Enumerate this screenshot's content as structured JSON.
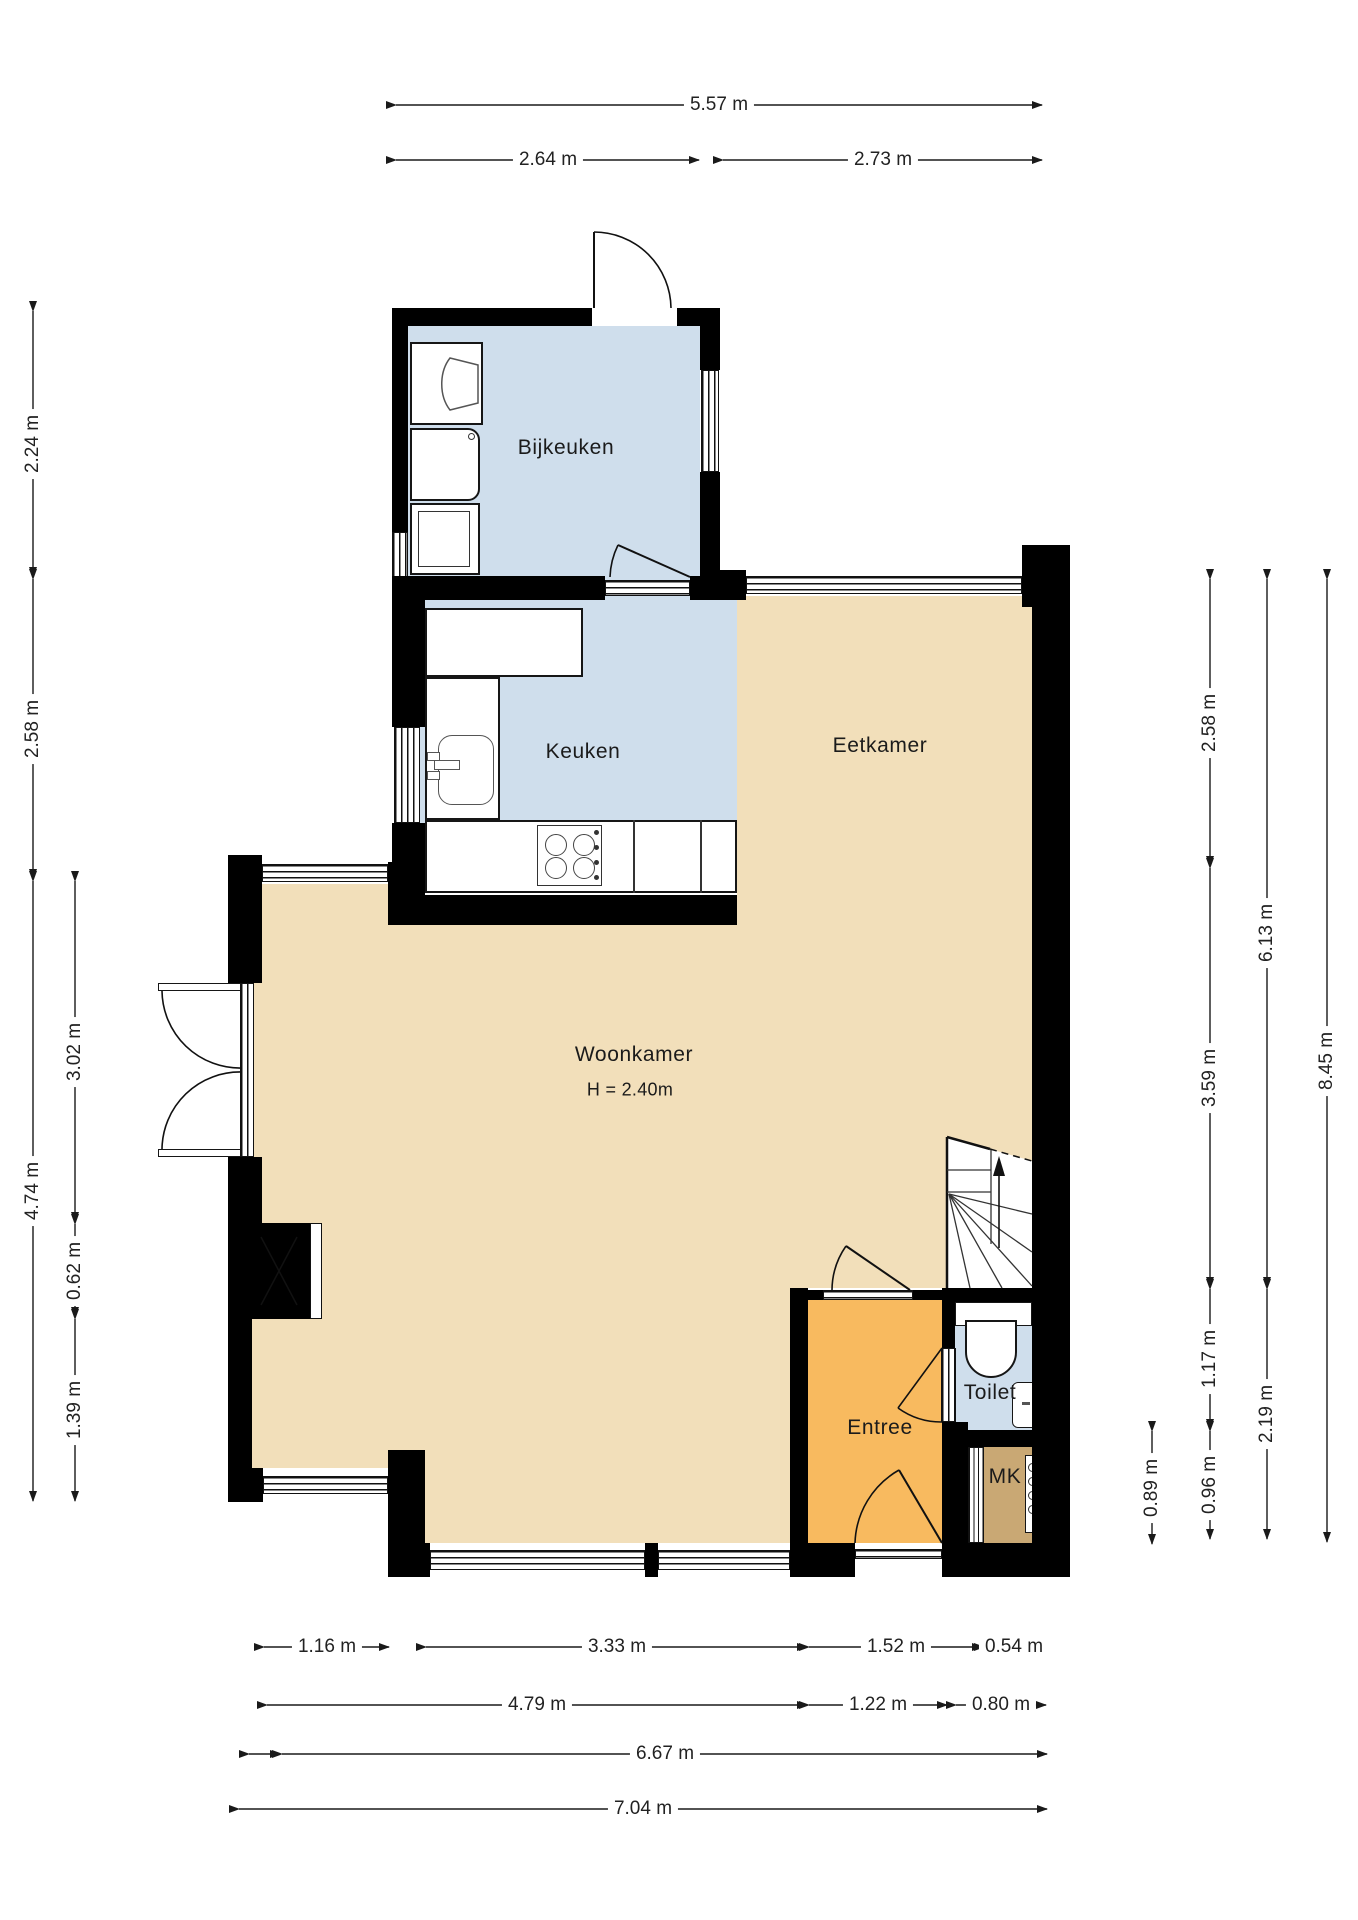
{
  "plan": {
    "type": "floorplan",
    "language": "nl"
  },
  "colors": {
    "wall": "#000000",
    "living": "#f2dfba",
    "kitchen": "#cfdeec",
    "entree": "#f8ba5f",
    "mk": "#c9a874",
    "line": "#1a1a1a"
  },
  "rooms": {
    "bijkeuken": {
      "label": "Bijkeuken"
    },
    "keuken": {
      "label": "Keuken"
    },
    "eetkamer": {
      "label": "Eetkamer"
    },
    "woonkamer": {
      "label": "Woonkamer",
      "height_note": "H = 2.40m"
    },
    "entree": {
      "label": "Entree"
    },
    "toilet": {
      "label": "Toilet"
    },
    "mk": {
      "label": "MK"
    }
  },
  "dimensions": {
    "top": [
      {
        "label": "5.57 m"
      },
      {
        "label": "2.64 m"
      },
      {
        "label": "2.73 m"
      }
    ],
    "left_outer": [
      {
        "label": "2.24 m"
      },
      {
        "label": "2.58 m"
      },
      {
        "label": "4.74 m"
      }
    ],
    "left_inner": [
      {
        "label": "3.02 m"
      },
      {
        "label": "0.62 m"
      },
      {
        "label": "1.39 m"
      }
    ],
    "right_col1": [
      {
        "label": "0.89 m"
      }
    ],
    "right_col2": [
      {
        "label": "2.58 m"
      },
      {
        "label": "3.59 m"
      },
      {
        "label": "1.17 m"
      },
      {
        "label": "0.96 m"
      }
    ],
    "right_col3": [
      {
        "label": "6.13 m"
      },
      {
        "label": "2.19 m"
      }
    ],
    "right_col4": [
      {
        "label": "8.45 m"
      }
    ],
    "bottom_row1": [
      {
        "label": "1.16 m"
      },
      {
        "label": "3.33 m"
      },
      {
        "label": "1.52 m"
      },
      {
        "label": "0.54 m"
      }
    ],
    "bottom_row2": [
      {
        "label": "4.79 m"
      },
      {
        "label": "1.22 m"
      },
      {
        "label": "0.80 m"
      }
    ],
    "bottom_row3": [
      {
        "label": "6.67 m"
      }
    ],
    "bottom_row4": [
      {
        "label": "7.04 m"
      }
    ]
  }
}
